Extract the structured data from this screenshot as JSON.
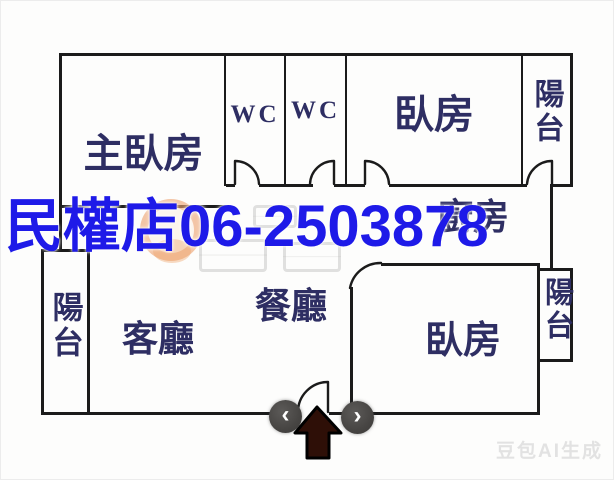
{
  "floorplan": {
    "rooms": [
      {
        "key": "master_bedroom",
        "label": "主臥房"
      },
      {
        "key": "wc_1",
        "label": "WC"
      },
      {
        "key": "wc_2",
        "label": "WC"
      },
      {
        "key": "bedroom_top",
        "label": "臥房"
      },
      {
        "key": "balcony_top_right",
        "label": "陽台"
      },
      {
        "key": "kitchen",
        "label": "廚房"
      },
      {
        "key": "balcony_left",
        "label": "陽台"
      },
      {
        "key": "living_room",
        "label": "客廳"
      },
      {
        "key": "dining_room",
        "label": "餐廳"
      },
      {
        "key": "bedroom_bottom",
        "label": "臥房"
      },
      {
        "key": "balcony_bottom_right",
        "label": "陽台"
      }
    ]
  },
  "overlay": {
    "text": "民權店06-2503878",
    "color": "#1e1ae8"
  },
  "carousel": {
    "prev_label": "‹",
    "next_label": "›"
  },
  "ai_watermark": {
    "label": "豆包AI生成"
  },
  "colors": {
    "wall": "#1b1b1b",
    "room_label": "#2e2e63",
    "overlay_blue": "#1e1ae8",
    "entry_arrow_fill": "#2e0f07",
    "nav_button_bg": "#474543",
    "agency_ring": "#ec9860"
  }
}
